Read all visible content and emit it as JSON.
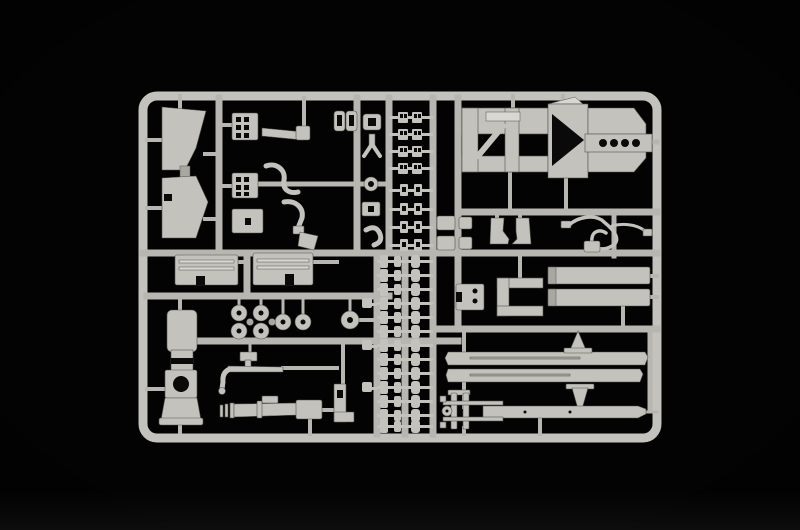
{
  "scene": {
    "subject": "plastic-model-kit-sprue-photo",
    "colors": {
      "bg": "#030303",
      "plastic": "#c3c2bc",
      "plastic-hi": "#d8d7d1",
      "plastic-lo": "#a8a7a1",
      "plastic-dim": "#b7b6b0",
      "hole": "#0a0a0a",
      "edge": "#54534e",
      "vignette": "#000000",
      "floor-glow": "#161616"
    }
  }
}
